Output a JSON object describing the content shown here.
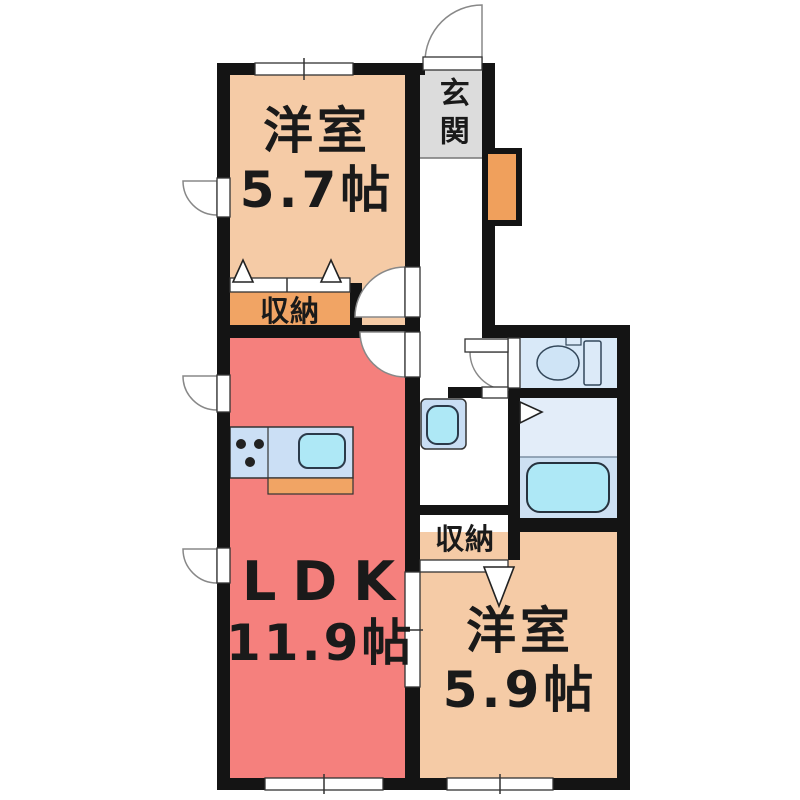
{
  "plan_title": "apartment-floor-plan",
  "rooms": {
    "entrance": {
      "label": "玄関"
    },
    "bedroom_top": {
      "label": "洋室",
      "size": "5.7帖"
    },
    "closet_top": {
      "label": "収納"
    },
    "ldk": {
      "label": "LDK",
      "size": "11.9帖"
    },
    "closet_bottom": {
      "label": "収納"
    },
    "bedroom_bottom": {
      "label": "洋室",
      "size": "5.9帖"
    }
  },
  "fixtures": [
    "toilet-icon",
    "bathtub-icon",
    "kitchen-counter",
    "kitchen-sink-icon",
    "stove-burners-icon",
    "washbasin-icon",
    "shoe-cabinet"
  ],
  "colors": {
    "wall": "#141414",
    "bedroom": "#f5cba6",
    "ldk": "#f5807d",
    "closet": "#f1a464",
    "shoe_cabinet": "#f0a05c",
    "entrance": "#dcdcdc",
    "toilet_room": "#d9e9f8",
    "bath_upper": "#e3edf9",
    "bath_lower": "#cde0f2",
    "water": "#aee8f6",
    "counter": "#cbdff5"
  }
}
